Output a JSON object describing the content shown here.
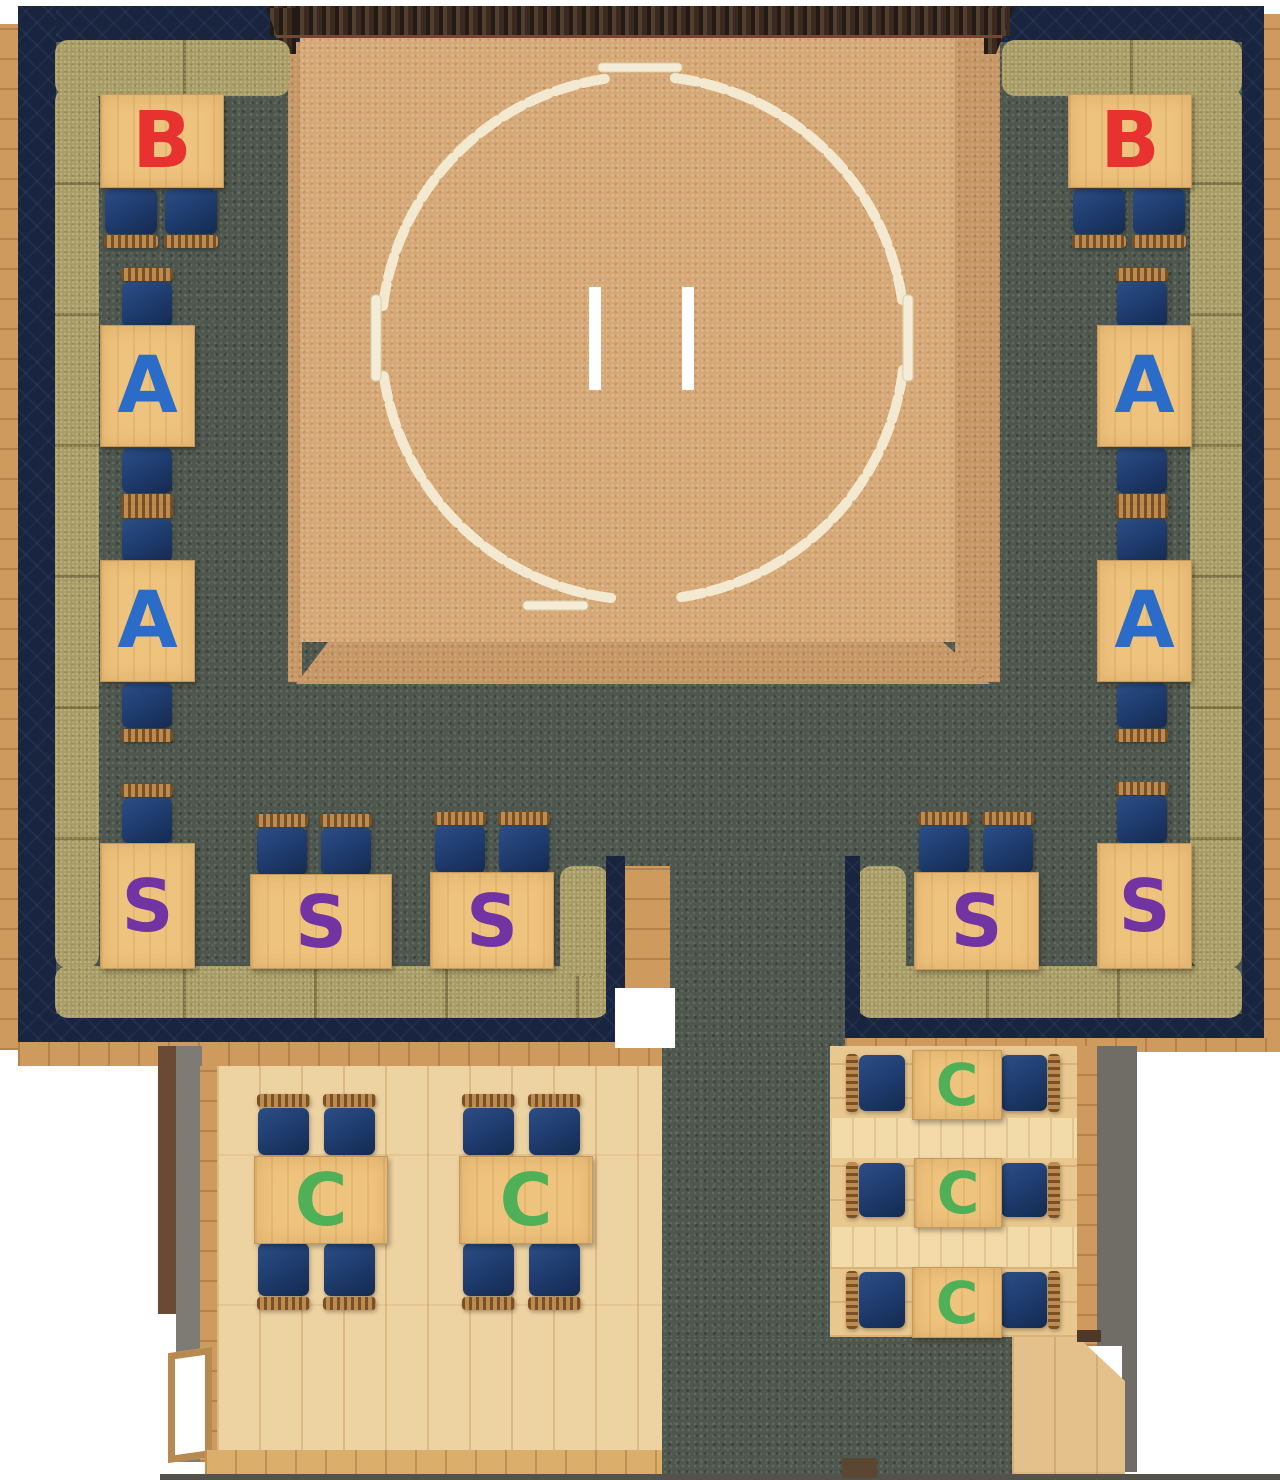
{
  "floor_plan": {
    "name": "sumo-theater-restaurant-seating-plan",
    "seat_classes": [
      {
        "code": "B",
        "color": "#e73230"
      },
      {
        "code": "A",
        "color": "#2a6cc7"
      },
      {
        "code": "S",
        "color": "#7134a2"
      },
      {
        "code": "C",
        "color": "#4fb058"
      }
    ],
    "tables": {
      "left_column": [
        {
          "label": "B",
          "color": "#e73230"
        },
        {
          "label": "A",
          "color": "#2a6cc7"
        },
        {
          "label": "A",
          "color": "#2a6cc7"
        },
        {
          "label": "S",
          "color": "#7134a2"
        }
      ],
      "bottom_left": [
        {
          "label": "S",
          "color": "#7134a2"
        },
        {
          "label": "S",
          "color": "#7134a2"
        }
      ],
      "bottom_right": [
        {
          "label": "S",
          "color": "#7134a2"
        },
        {
          "label": "S",
          "color": "#7134a2"
        }
      ],
      "right_column": [
        {
          "label": "B",
          "color": "#e73230"
        },
        {
          "label": "A",
          "color": "#2a6cc7"
        },
        {
          "label": "A",
          "color": "#2a6cc7"
        },
        {
          "label": "S",
          "color": "#7134a2"
        }
      ],
      "room_left": [
        {
          "label": "C",
          "color": "#4fb058"
        },
        {
          "label": "C",
          "color": "#4fb058"
        }
      ],
      "room_right": [
        {
          "label": "C",
          "color": "#4fb058"
        },
        {
          "label": "C",
          "color": "#4fb058"
        },
        {
          "label": "C",
          "color": "#4fb058"
        }
      ]
    }
  }
}
